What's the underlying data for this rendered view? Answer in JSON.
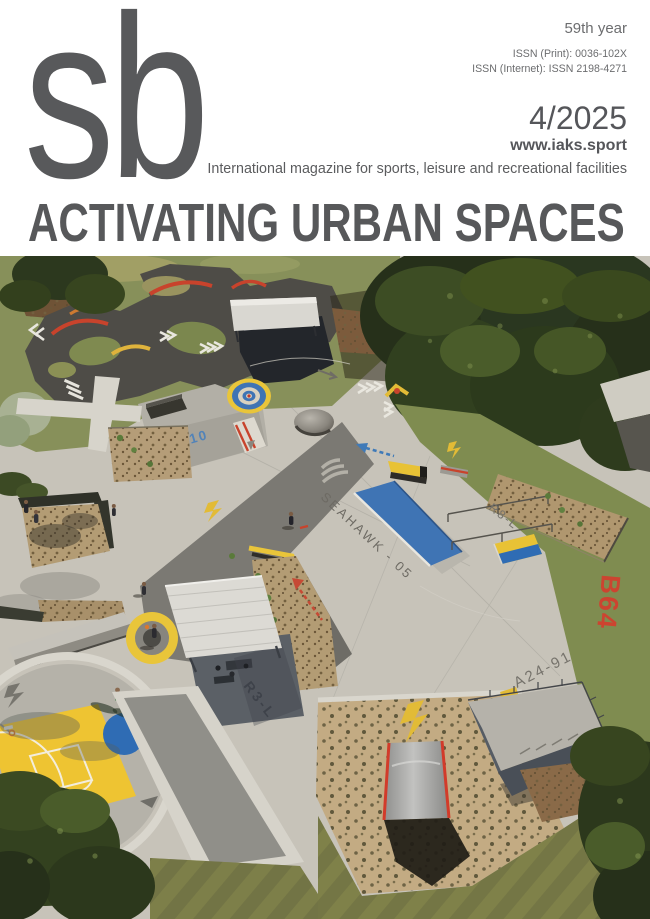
{
  "cover": {
    "logo": "sb",
    "edition_note": "59th year",
    "issn_print": "ISSN (Print): 0036-102X",
    "issn_internet": "ISSN (Internet): ISSN 2198-4271",
    "issue": "4/2025",
    "website": "www.iaks.sport",
    "tagline": "International magazine for sports, leisure and recreational facilities",
    "title": "ACTIVATING URBAN SPACES",
    "masthead_gray": "#58595b"
  },
  "photo": {
    "markings": {
      "bank_code": "A24-10",
      "street_name": "SEAHAWK - 05",
      "rail_code": "R8-L",
      "red_code": "B64",
      "flat_code": "A24-91",
      "shelter_code": "R3-L"
    },
    "palette": {
      "concrete": "#c7c3b9",
      "asphalt": "#4e4c47",
      "grass": "#7d8a4e",
      "trees": "#2c381e",
      "mulch": "#b09673",
      "accent_yellow": "#e9c53a",
      "accent_blue": "#3a72b4",
      "accent_red": "#cc4430",
      "stencil_blue": "#4a80bc",
      "stencil_gray": "#73706a"
    }
  }
}
